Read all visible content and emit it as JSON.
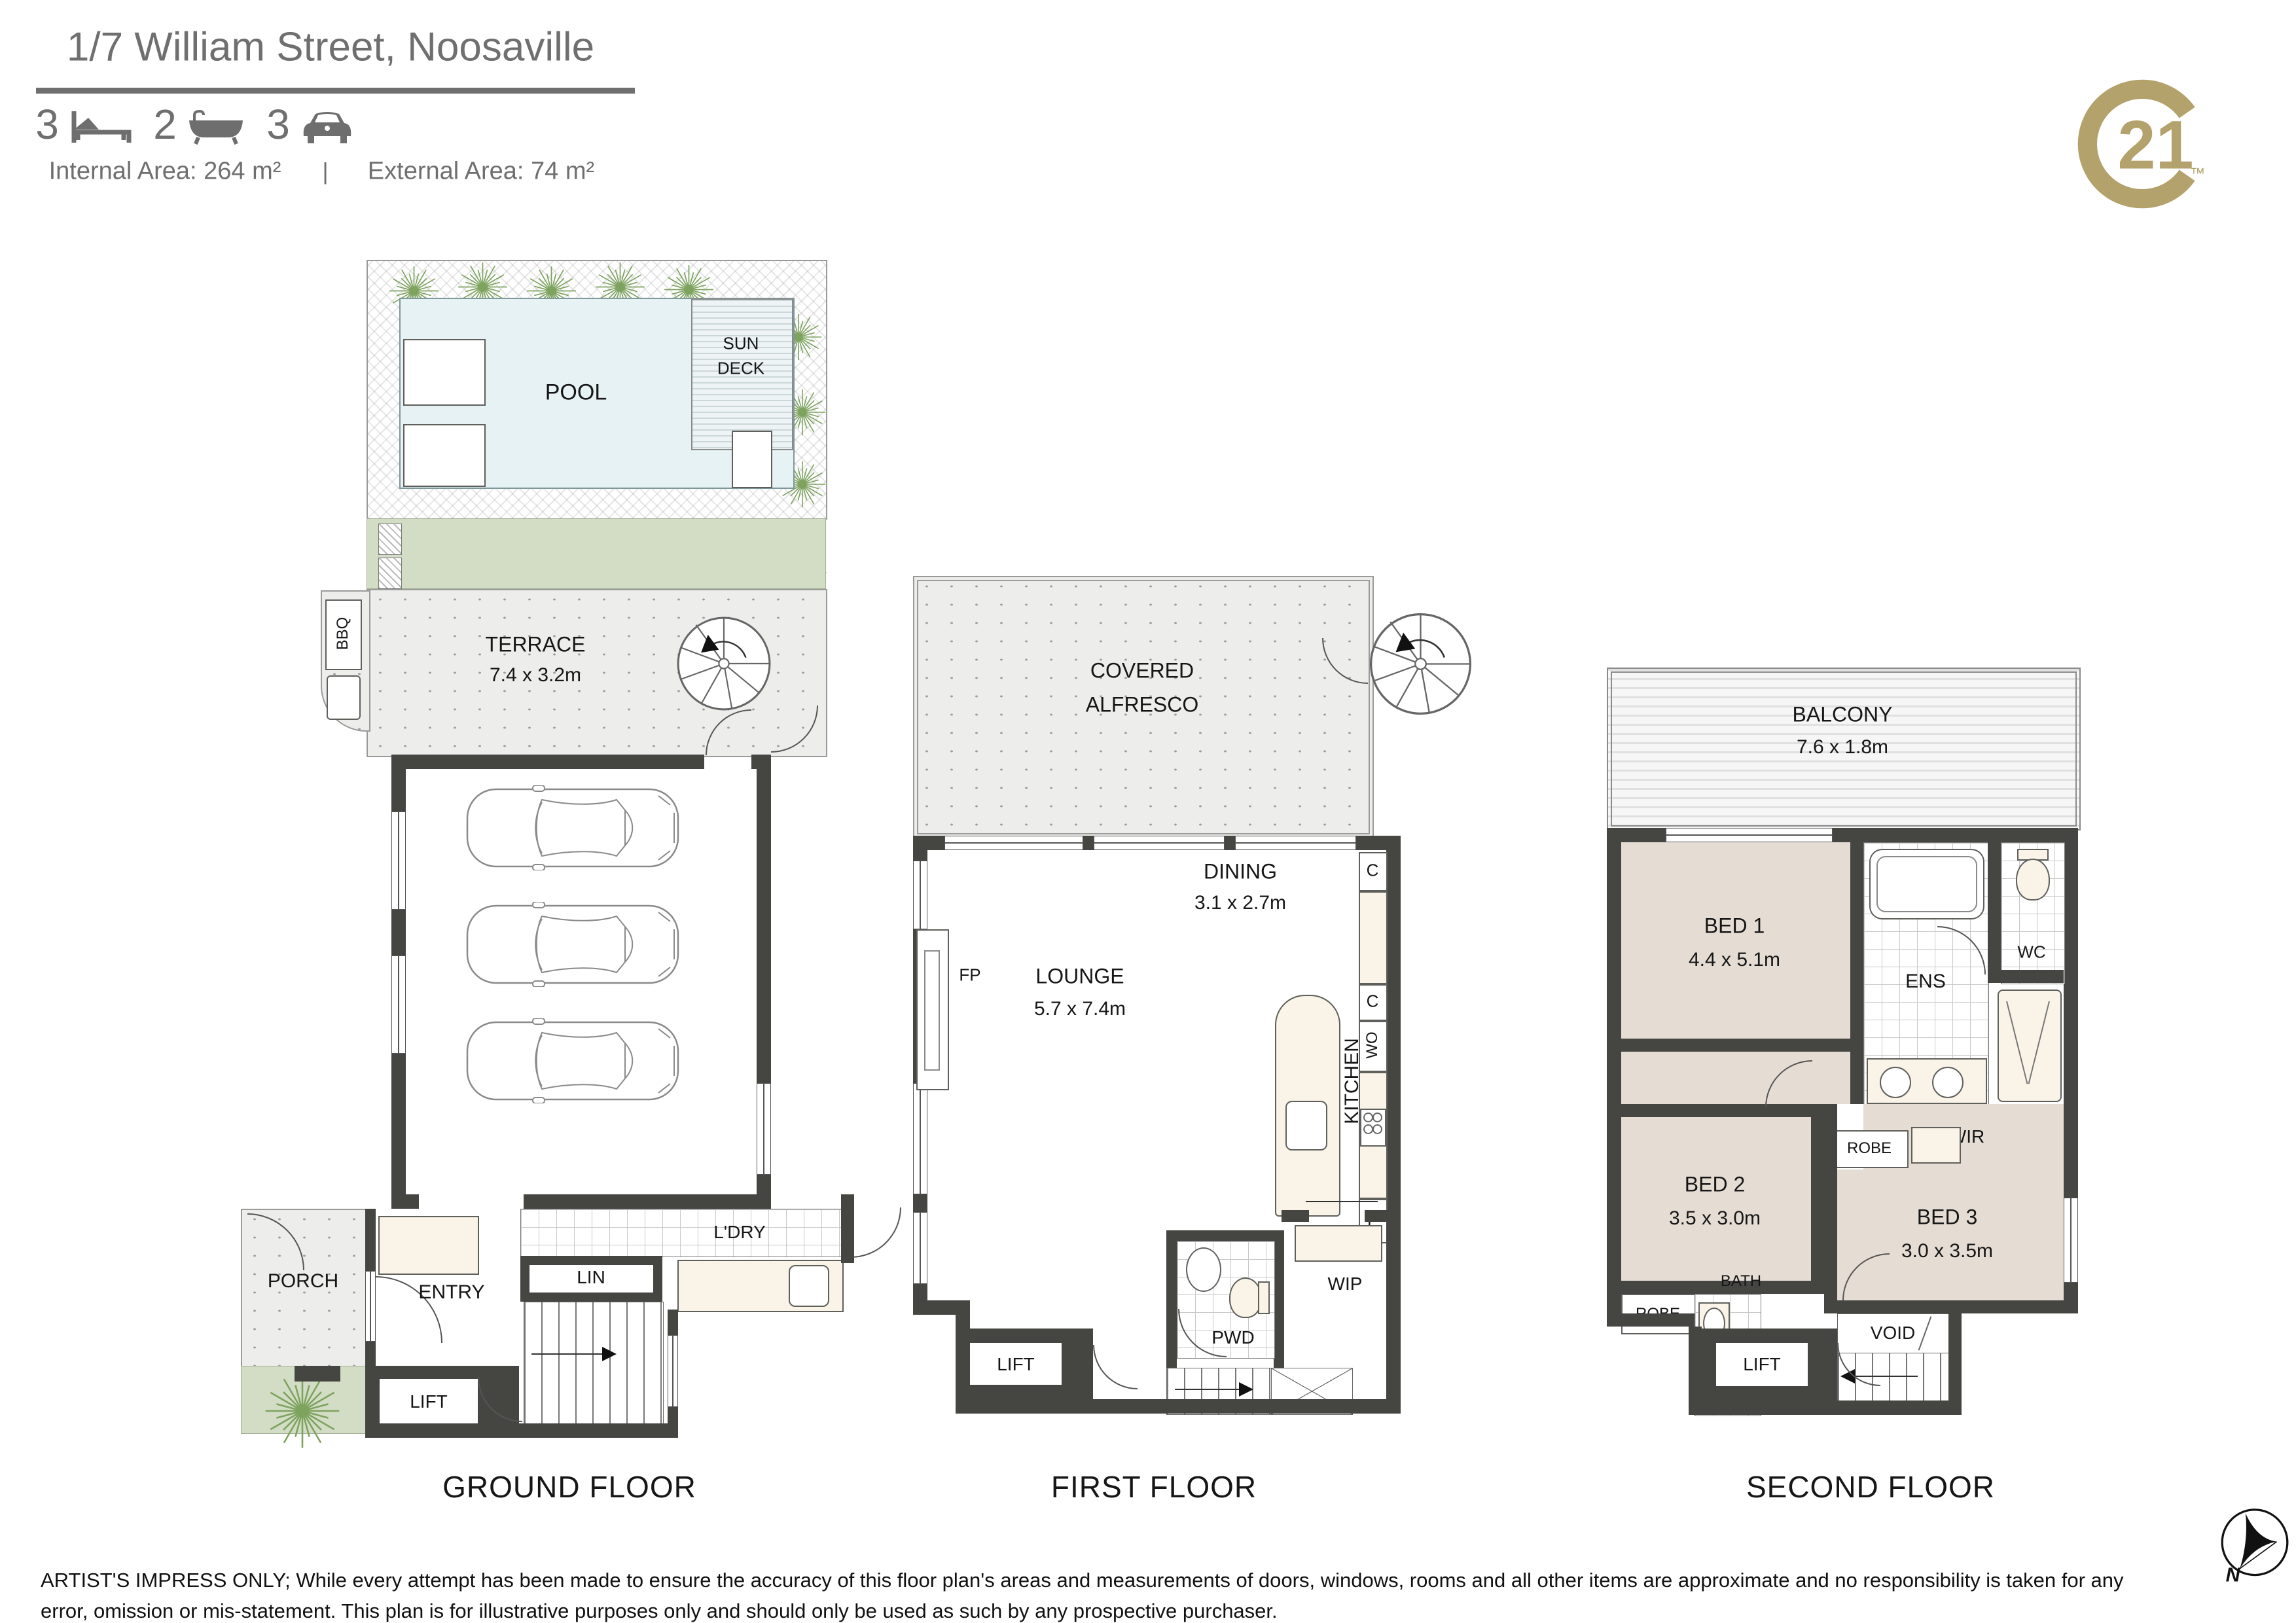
{
  "header": {
    "title": "1/7 William Street, Noosaville",
    "beds": "3",
    "baths": "2",
    "cars": "3",
    "internal_area": "Internal Area: 264 m²",
    "separator": "|",
    "external_area": "External Area: 74 m²"
  },
  "logo": {
    "number": "21",
    "trademark": "™"
  },
  "ground_floor": {
    "label": "GROUND FLOOR",
    "pool": "POOL",
    "sun_deck_line1": "SUN",
    "sun_deck_line2": "DECK",
    "terrace": "TERRACE",
    "terrace_dim": "7.4 x 3.2m",
    "bbq": "BBQ",
    "garage": "GARAGE",
    "garage_dim": "6.0 x 8.1m",
    "porch": "PORCH",
    "entry": "ENTRY",
    "lift": "LIFT",
    "lin": "LIN",
    "laundry": "L'DRY"
  },
  "first_floor": {
    "label": "FIRST FLOOR",
    "alfresco_line1": "COVERED",
    "alfresco_line2": "ALFRESCO",
    "dining": "DINING",
    "dining_dim": "3.1 x 2.7m",
    "lounge": "LOUNGE",
    "lounge_dim": "5.7 x 7.4m",
    "fireplace": "FP",
    "kitchen": "KITCHEN",
    "kitchen_dim": "3.1 x 5.4m",
    "cupboard_1": "C",
    "cupboard_2": "C",
    "wall_oven": "WO",
    "fridge": "F",
    "powder": "PWD",
    "pantry": "WIP",
    "lift": "LIFT"
  },
  "second_floor": {
    "label": "SECOND FLOOR",
    "balcony": "BALCONY",
    "balcony_dim": "7.6 x 1.8m",
    "bed1": "BED 1",
    "bed1_dim": "4.4 x 5.1m",
    "ensuite": "ENS",
    "wc": "WC",
    "wir": "WIR",
    "robe_bed3": "ROBE",
    "bed2": "BED 2",
    "bed2_dim": "3.5 x 3.0m",
    "robe_bed2": "ROBE",
    "bed3": "BED 3",
    "bed3_dim": "3.0 x 3.5m",
    "bath": "BATH",
    "void": "VOID",
    "lift": "LIFT"
  },
  "footer": {
    "disclaimer": "ARTIST'S IMPRESS ONLY; While every attempt has been made to ensure the accuracy of this floor plan's areas and measurements of doors, windows, rooms and all other items are approximate and no responsibility is taken for any error, omission or mis-statement. This plan is for illustrative purposes only and should only be used as such by any prospective purchaser."
  },
  "compass": {
    "north_label": "N"
  },
  "colors": {
    "brand_gold": "#B3A26B",
    "wall": "#454542",
    "pool_water": "#E7F2F5",
    "garden_green": "#D3DCC5",
    "carpet_beige": "#E5DDD4",
    "fixture_cream": "#FAF3E8"
  }
}
